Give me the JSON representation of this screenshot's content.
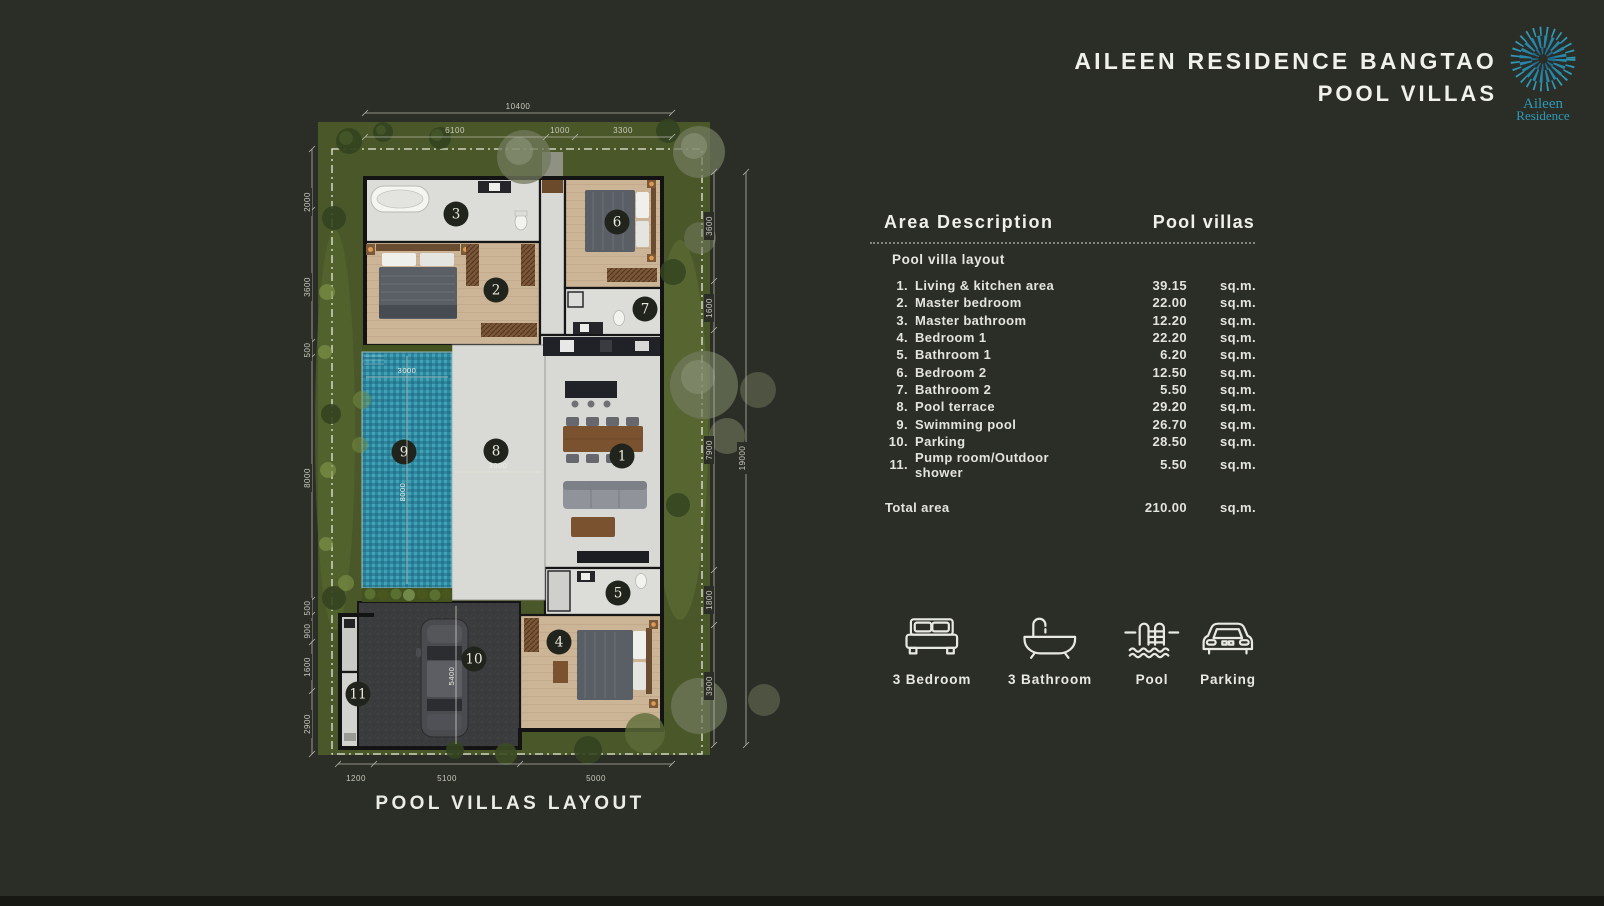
{
  "page": {
    "background": "#2b2d27",
    "accent_teal": "#2e9ab8"
  },
  "header": {
    "title_line1": "AILEEN RESIDENCE BANGTAO",
    "title_line2": "POOL VILLAS",
    "logo_line1": "Aileen",
    "logo_line2": "Residence"
  },
  "plan": {
    "caption": "POOL VILLAS LAYOUT",
    "room_numbers": [
      "1",
      "2",
      "3",
      "4",
      "5",
      "6",
      "7",
      "8",
      "9",
      "10",
      "11"
    ],
    "dims": {
      "top_total": "10400",
      "top": [
        "6100",
        "1000",
        "3300"
      ],
      "left": [
        "2000",
        "3600",
        "500",
        "8000",
        "500",
        "900",
        "1600",
        "2900"
      ],
      "right": [
        "3600",
        "1600",
        "7900",
        "1800",
        "3900"
      ],
      "right_total": "19000",
      "bottom": [
        "1200",
        "5100",
        "5000"
      ],
      "pool_width": "3000",
      "pool_length": "8000",
      "terrace_width": "3000",
      "parking_length": "5400"
    }
  },
  "area_table": {
    "title": "Area Description",
    "column_title": "Pool villas",
    "section": "Pool villa layout",
    "unit": "sq.m.",
    "rows": [
      {
        "no": "1.",
        "label": "Living & kitchen area",
        "value": "39.15"
      },
      {
        "no": "2.",
        "label": "Master bedroom",
        "value": "22.00"
      },
      {
        "no": "3.",
        "label": "Master bathroom",
        "value": "12.20"
      },
      {
        "no": "4.",
        "label": "Bedroom 1",
        "value": "22.20"
      },
      {
        "no": "5.",
        "label": "Bathroom 1",
        "value": "6.20"
      },
      {
        "no": "6.",
        "label": "Bedroom 2",
        "value": "12.50"
      },
      {
        "no": "7.",
        "label": "Bathroom 2",
        "value": "5.50"
      },
      {
        "no": "8.",
        "label": "Pool terrace",
        "value": "29.20"
      },
      {
        "no": "9.",
        "label": "Swimming pool",
        "value": "26.70"
      },
      {
        "no": "10.",
        "label": "Parking",
        "value": "28.50"
      },
      {
        "no": "11.",
        "label": "Pump room/Outdoor shower",
        "value": "5.50"
      }
    ],
    "total_label": "Total area",
    "total_value": "210.00"
  },
  "features": [
    {
      "label": "3 Bedroom"
    },
    {
      "label": "3 Bathroom"
    },
    {
      "label": "Pool"
    },
    {
      "label": "Parking"
    }
  ]
}
